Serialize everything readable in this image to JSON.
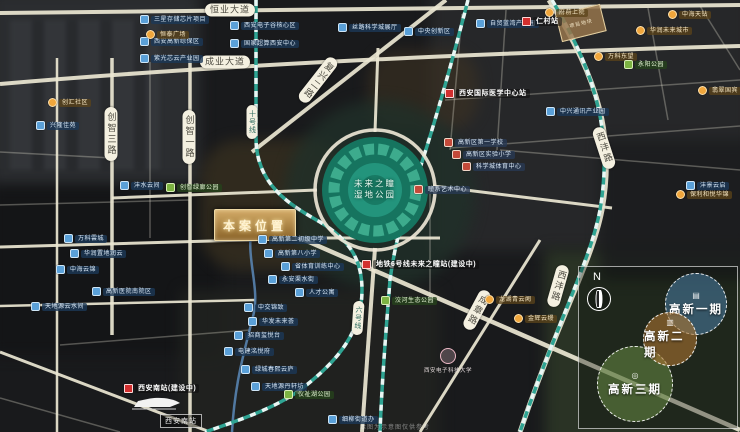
{
  "park": {
    "line1": "未来之瞳",
    "line2": "湿地公园"
  },
  "banner": {
    "text": "本案位置"
  },
  "parcel": {
    "text": "项目地块"
  },
  "station": {
    "badge": "西安南站(建设中)",
    "box": "西安南站"
  },
  "university": {
    "name": "西安电子科技大学"
  },
  "watermark": "本图为示意图仅供参考",
  "legend": {
    "north": "N",
    "phases": [
      {
        "label": "高新一期",
        "icon": "▤",
        "x": 86,
        "y": 6,
        "size": 60,
        "fill": "rgba(74,127,168,0.55)"
      },
      {
        "label": "高新三期",
        "icon": "◎",
        "x": 18,
        "y": 79,
        "size": 74,
        "fill": "rgba(112,150,72,0.5)"
      },
      {
        "label": "高新二期",
        "icon": "▥",
        "x": 64,
        "y": 45,
        "size": 52,
        "fill": "rgba(170,115,48,0.6)"
      }
    ]
  },
  "road_labels": [
    {
      "t": "恒业大道",
      "x": 230,
      "y": 10
    },
    {
      "t": "成业大道",
      "x": 225,
      "y": 62
    },
    {
      "t": "创智三路",
      "x": 111,
      "y": 134,
      "vert": 1
    },
    {
      "t": "创智一路",
      "x": 189,
      "y": 137,
      "vert": 1
    },
    {
      "t": "复兴二路",
      "x": 318,
      "y": 80,
      "vert": 1,
      "rot": 38
    },
    {
      "t": "西沣路",
      "x": 604,
      "y": 148,
      "vert": 1,
      "rot": -18
    },
    {
      "t": "西沣路",
      "x": 558,
      "y": 286,
      "vert": 1,
      "rot": 16
    },
    {
      "t": "成章路",
      "x": 477,
      "y": 310,
      "vert": 1,
      "rot": 28
    },
    {
      "t": "十号线",
      "x": 252,
      "y": 122,
      "vert": 1,
      "small": 1
    },
    {
      "t": "六号线",
      "x": 358,
      "y": 318,
      "vert": 1,
      "small": 1,
      "rot": 4
    }
  ],
  "markers": [
    {
      "type": "blue",
      "x": 140,
      "y": 15,
      "label": "三星存储芯片项目"
    },
    {
      "type": "blue",
      "x": 140,
      "y": 37,
      "label": "西安高新综保区"
    },
    {
      "type": "blue",
      "x": 140,
      "y": 54,
      "label": "紫光芯云产业园"
    },
    {
      "type": "blue",
      "x": 230,
      "y": 21,
      "label": "西安电子谷核心区"
    },
    {
      "type": "blue",
      "x": 230,
      "y": 39,
      "label": "国家超算西安中心"
    },
    {
      "type": "blue",
      "x": 338,
      "y": 23,
      "label": "丝路科学城展厅"
    },
    {
      "type": "blue",
      "x": 404,
      "y": 27,
      "label": "中央创新区"
    },
    {
      "type": "blue",
      "x": 476,
      "y": 19,
      "label": "自贸蓝湾产业园"
    },
    {
      "type": "orange",
      "x": 146,
      "y": 30,
      "label": "恒泰广场"
    },
    {
      "type": "orange",
      "x": 48,
      "y": 98,
      "label": "创汇社区"
    },
    {
      "type": "blue",
      "x": 36,
      "y": 121,
      "label": "兴隆佳苑"
    },
    {
      "type": "blue",
      "x": 120,
      "y": 181,
      "label": "沣水云间"
    },
    {
      "type": "green",
      "x": 166,
      "y": 183,
      "label": "创智绿廊公园"
    },
    {
      "type": "orange",
      "x": 545,
      "y": 8,
      "label": "府前上院"
    },
    {
      "type": "orange",
      "x": 668,
      "y": 10,
      "label": "中海天钻"
    },
    {
      "type": "orange",
      "x": 636,
      "y": 26,
      "label": "华润未来城市"
    },
    {
      "type": "orange",
      "x": 594,
      "y": 52,
      "label": "万科东望"
    },
    {
      "type": "green",
      "x": 624,
      "y": 60,
      "label": "永阳公园"
    },
    {
      "type": "orange",
      "x": 698,
      "y": 86,
      "label": "翡翠国宾"
    },
    {
      "type": "blue",
      "x": 546,
      "y": 107,
      "label": "中兴通讯产业园"
    },
    {
      "type": "blue",
      "x": 686,
      "y": 181,
      "label": "沣景云启"
    },
    {
      "type": "orange",
      "x": 676,
      "y": 190,
      "label": "保利和悦华锦"
    },
    {
      "type": "school",
      "x": 444,
      "y": 138,
      "label": "高新区第一学校"
    },
    {
      "type": "school",
      "x": 452,
      "y": 150,
      "label": "高新区实验小学"
    },
    {
      "type": "school",
      "x": 462,
      "y": 162,
      "label": "科学城体育中心"
    },
    {
      "type": "school",
      "x": 414,
      "y": 185,
      "label": "瞳系艺术中心"
    },
    {
      "type": "blue",
      "x": 258,
      "y": 235,
      "label": "高新第二初级中学"
    },
    {
      "type": "blue",
      "x": 264,
      "y": 249,
      "label": "高新第八小学"
    },
    {
      "type": "blue",
      "x": 281,
      "y": 262,
      "label": "省体育训练中心"
    },
    {
      "type": "blue",
      "x": 268,
      "y": 275,
      "label": "永安渠水街"
    },
    {
      "type": "blue",
      "x": 295,
      "y": 288,
      "label": "人才公寓"
    },
    {
      "type": "blue",
      "x": 92,
      "y": 287,
      "label": "高新医院南院区"
    },
    {
      "type": "blue",
      "x": 64,
      "y": 234,
      "label": "万科雲城"
    },
    {
      "type": "blue",
      "x": 70,
      "y": 249,
      "label": "华润置地润云"
    },
    {
      "type": "blue",
      "x": 56,
      "y": 265,
      "label": "中海云锦"
    },
    {
      "type": "blue",
      "x": 31,
      "y": 302,
      "label": "天地源云水间"
    },
    {
      "type": "blue",
      "x": 244,
      "y": 303,
      "label": "中交锦致"
    },
    {
      "type": "blue",
      "x": 248,
      "y": 317,
      "label": "华发未来荟"
    },
    {
      "type": "blue",
      "x": 234,
      "y": 331,
      "label": "招商玺悦台"
    },
    {
      "type": "blue",
      "x": 224,
      "y": 347,
      "label": "电建洺悦府"
    },
    {
      "type": "blue",
      "x": 241,
      "y": 365,
      "label": "绿城春熙云庐"
    },
    {
      "type": "blue",
      "x": 251,
      "y": 382,
      "label": "天地源丹轩坊"
    },
    {
      "type": "blue",
      "x": 328,
      "y": 415,
      "label": "细柳街道办"
    },
    {
      "type": "green",
      "x": 381,
      "y": 296,
      "label": "洨河生态公园"
    },
    {
      "type": "green",
      "x": 284,
      "y": 390,
      "label": "仪祉湖公园"
    },
    {
      "type": "orange",
      "x": 485,
      "y": 295,
      "label": "龙湖青云阙"
    },
    {
      "type": "orange",
      "x": 514,
      "y": 314,
      "label": "金辉云缦"
    },
    {
      "type": "red",
      "x": 522,
      "y": 17,
      "label": "仁村站"
    },
    {
      "type": "red",
      "x": 445,
      "y": 89,
      "label": "西安国际医学中心站"
    },
    {
      "type": "red",
      "x": 362,
      "y": 260,
      "label": "地铁6号线未来之瞳站(建设中)"
    },
    {
      "type": "red",
      "x": 124,
      "y": 384,
      "label": "西安南站(建设中)"
    }
  ]
}
